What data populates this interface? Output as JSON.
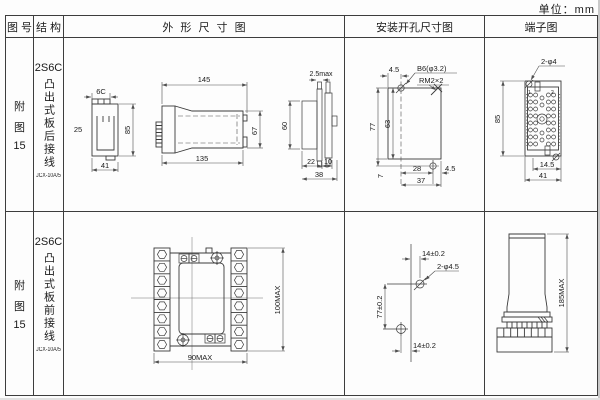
{
  "unit": "单位：mm",
  "header": {
    "fig_no": "图 号",
    "structure": "结 构",
    "outline": "外 形 尺 寸 图",
    "mounting": "安装开孔尺寸图",
    "terminal": "端子图"
  },
  "r1": {
    "fig": {
      "l1": "附",
      "l2": "图",
      "l3": "15"
    },
    "model": "2S6C",
    "wiring": "凸出式板后接线",
    "case_code": "JCX-10A/5",
    "outline": {
      "tab_width": "6C",
      "front_side": "25",
      "front_width": "41",
      "front_height": "85",
      "side_top": "145",
      "side_bottom": "135",
      "side_height": "67",
      "panel_thickness": "2.5max",
      "panel_height": "60",
      "panel_d1": "22",
      "panel_d2": "10",
      "panel_width": "38"
    },
    "mounting": {
      "top_offset": "4.5",
      "hole_note": "B6(φ3.2)",
      "thread_note": "RM2×2",
      "total_height": "77",
      "inner_height": "63",
      "bottom_offset": "7",
      "hole_span": "28",
      "side_offset": "4.5",
      "total_width": "37"
    },
    "terminal": {
      "hole_note": "2-φ4",
      "pin_left": "1",
      "pin_right": "2",
      "height": "85",
      "center_offset": "14.5",
      "width": "41"
    }
  },
  "r2": {
    "fig": {
      "l1": "附",
      "l2": "图",
      "l3": "15"
    },
    "model": "2S6C",
    "wiring": "凸出式板前接线",
    "case_code": "JCX-10A/5",
    "outline": {
      "width": "90MAX",
      "height": "100MAX"
    },
    "mounting": {
      "top_offset": "14±0.2",
      "hole_note": "2-φ4.5",
      "hole_span": "77±0.2",
      "bottom_offset": "14±0.2"
    },
    "terminal": {
      "height": "185MAX"
    }
  }
}
